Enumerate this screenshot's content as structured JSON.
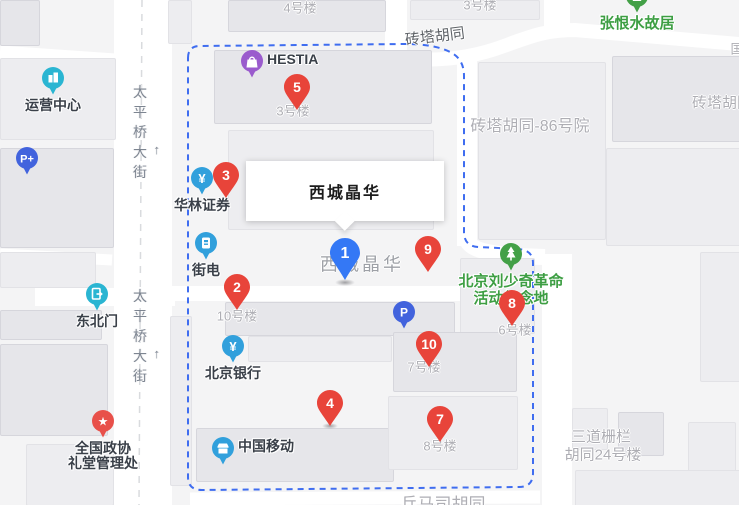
{
  "info_box": {
    "title": "西城晶华"
  },
  "colors": {
    "marker_red": "#e8443a",
    "marker_blue": "#3478f5",
    "poi_blue": "#31a0dc",
    "poi_cyan": "#2ab5d2",
    "poi_parking": "#4263dd",
    "poi_purple": "#9a5bcd",
    "poi_green": "#43a047",
    "poi_star_red": "#e8504a",
    "boundary_blue": "#3f6df0"
  },
  "numbered_markers": [
    {
      "num": "1",
      "style": "blue",
      "x": 345,
      "y": 253
    },
    {
      "num": "2",
      "style": "red",
      "x": 237,
      "y": 287
    },
    {
      "num": "3",
      "style": "red",
      "x": 226,
      "y": 175
    },
    {
      "num": "4",
      "style": "red",
      "x": 330,
      "y": 403
    },
    {
      "num": "5",
      "style": "red",
      "x": 297,
      "y": 87
    },
    {
      "num": "7",
      "style": "red",
      "x": 440,
      "y": 419
    },
    {
      "num": "8",
      "style": "red",
      "x": 512,
      "y": 303
    },
    {
      "num": "9",
      "style": "red",
      "x": 428,
      "y": 249
    },
    {
      "num": "10",
      "style": "red",
      "x": 429,
      "y": 344
    }
  ],
  "poi_markers": [
    {
      "name": "运营中心",
      "icon": "building",
      "color": "#2ab5d2",
      "x": 53,
      "y": 78,
      "label_pos": "below"
    },
    {
      "name": "",
      "icon": "parking-plus",
      "color": "#4263dd",
      "x": 27,
      "y": 158,
      "label_pos": "none"
    },
    {
      "name": "东北门",
      "icon": "door",
      "color": "#2ab5d2",
      "x": 97,
      "y": 294,
      "label_pos": "below"
    },
    {
      "name": "全国政协\n礼堂管理处",
      "icon": "star",
      "color": "#e8504a",
      "x": 103,
      "y": 421,
      "label_pos": "below"
    },
    {
      "name": "HESTIA",
      "icon": "bag",
      "color": "#9a5bcd",
      "x": 252,
      "y": 61,
      "label_pos": "right"
    },
    {
      "name": "华林证券",
      "icon": "yuan",
      "color": "#31a0dc",
      "x": 202,
      "y": 178,
      "label_pos": "below"
    },
    {
      "name": "街电",
      "icon": "powerbank",
      "color": "#31a0dc",
      "x": 206,
      "y": 243,
      "label_pos": "below"
    },
    {
      "name": "北京银行",
      "icon": "yuan",
      "color": "#31a0dc",
      "x": 233,
      "y": 346,
      "label_pos": "below"
    },
    {
      "name": "中国移动",
      "icon": "shop",
      "color": "#31a0dc",
      "x": 223,
      "y": 448,
      "label_pos": "right"
    },
    {
      "name": "张恨水故居",
      "icon": "house",
      "color": "#43a047",
      "x": 637,
      "y": -4,
      "label_pos": "below",
      "label_color": "green"
    },
    {
      "name": "北京刘少奇革命\n活动纪念地",
      "icon": "tree",
      "color": "#43a047",
      "x": 511,
      "y": 254,
      "label_pos": "below",
      "label_color": "green"
    },
    {
      "name": "",
      "icon": "parking",
      "color": "#4263dd",
      "x": 404,
      "y": 312,
      "label_pos": "none"
    }
  ],
  "area_labels": [
    {
      "text": "4号楼",
      "x": 300,
      "y": 9,
      "size": 13
    },
    {
      "text": "3号楼",
      "x": 480,
      "y": 6,
      "size": 13
    },
    {
      "text": "3号楼",
      "x": 293,
      "y": 112,
      "size": 13
    },
    {
      "text": "10号楼",
      "x": 237,
      "y": 317,
      "size": 13
    },
    {
      "text": "6号楼",
      "x": 515,
      "y": 331,
      "size": 13
    },
    {
      "text": "7号楼",
      "x": 424,
      "y": 368,
      "size": 13
    },
    {
      "text": "8号楼",
      "x": 440,
      "y": 447,
      "size": 13
    },
    {
      "text": "西城晶华",
      "x": 362,
      "y": 265,
      "size": 18,
      "big": true
    },
    {
      "text": "砖塔胡同-86号院",
      "x": 530,
      "y": 127,
      "size": 16
    },
    {
      "text": "三道栅栏",
      "x": 601,
      "y": 437,
      "size": 15
    },
    {
      "text": "胡同24号楼",
      "x": 603,
      "y": 455,
      "size": 15
    },
    {
      "text": "国",
      "x": 737,
      "y": 50,
      "size": 13
    },
    {
      "text": "砖塔胡同",
      "x": 722,
      "y": 103,
      "size": 15
    },
    {
      "text": "兵马司胡同",
      "x": 443,
      "y": 505,
      "size": 17
    }
  ],
  "street_labels": [
    {
      "text": "砖塔胡同",
      "x": 435,
      "y": 37,
      "rot": -7
    }
  ],
  "vertical_streets": [
    {
      "text": "太平桥大街",
      "arrow": "↑",
      "x": 140,
      "y": 85
    },
    {
      "text": "太平桥大街",
      "arrow": "↑",
      "x": 140,
      "y": 289
    }
  ]
}
